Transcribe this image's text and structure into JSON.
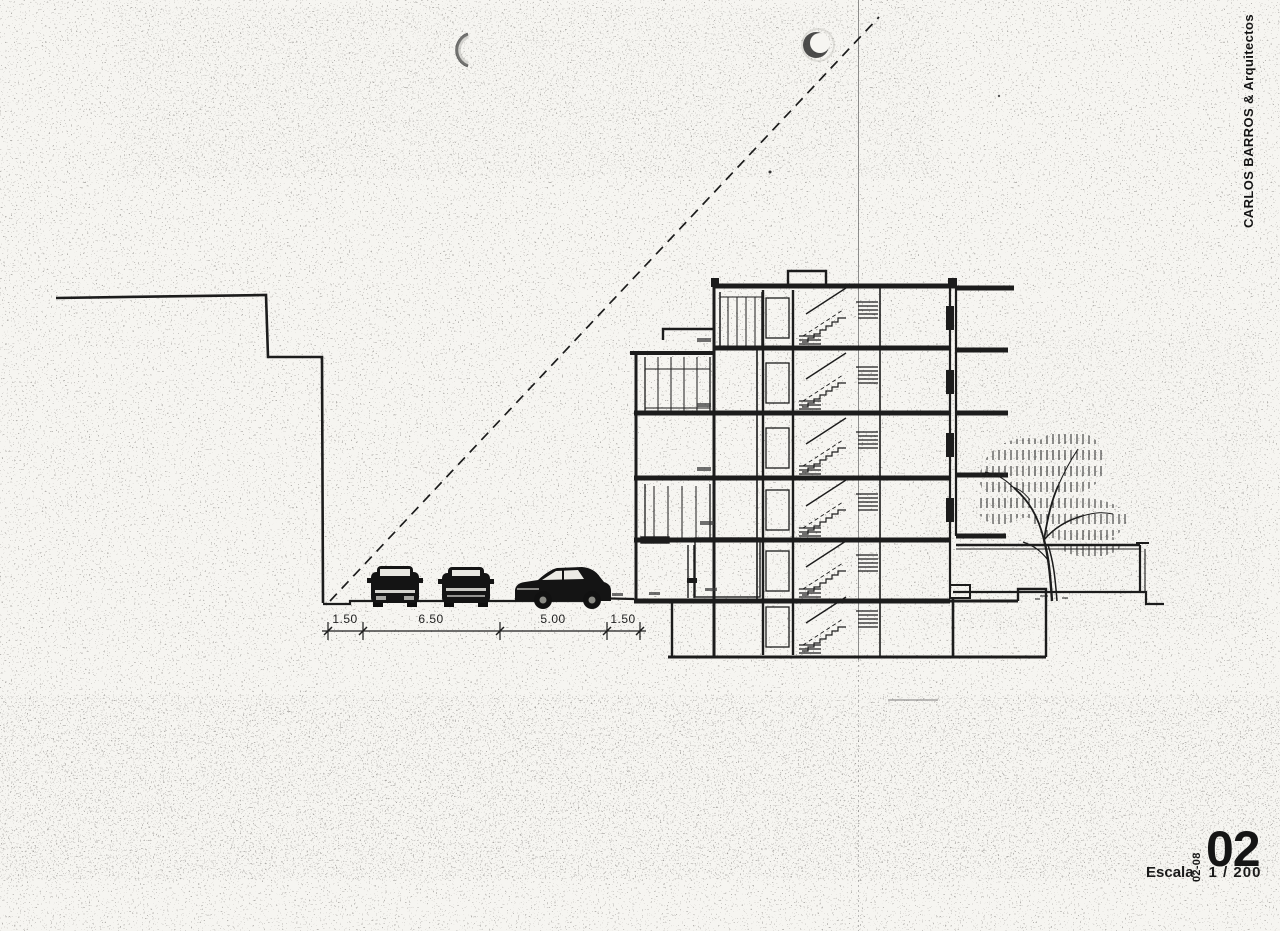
{
  "page": {
    "background": "#f6f5f1",
    "ink": "#1c1c1c"
  },
  "title_block": {
    "architect": "CARLOS BARROS & Arquitectos",
    "sheet_code": "02-08",
    "sheet_number": "02",
    "scale_label": "Escala",
    "scale_value": "1 / 200"
  },
  "drawing": {
    "type": "building-cross-section-with-street",
    "street_dimensions_m": [
      "1.50",
      "6.50",
      "5.00",
      "1.50"
    ]
  }
}
